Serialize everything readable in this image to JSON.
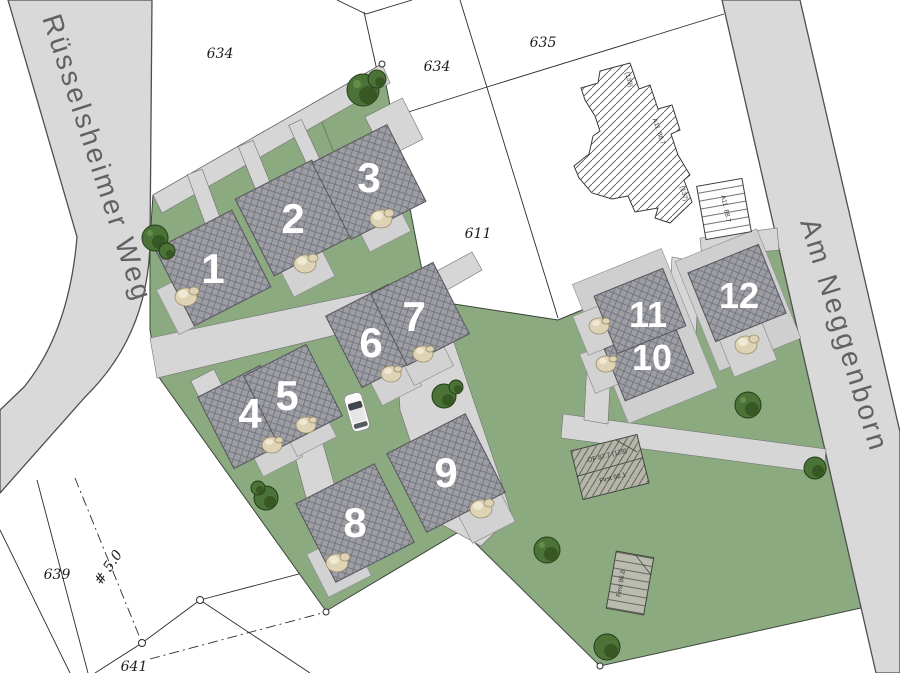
{
  "map": {
    "title": "Lageplan Baugebiet",
    "streets": [
      {
        "label": "Rüsselsheimer Weg"
      },
      {
        "label": "Am Neggenborn"
      }
    ],
    "parcels": [
      {
        "label": "634"
      },
      {
        "label": "634"
      },
      {
        "label": "635"
      },
      {
        "label": "611"
      },
      {
        "label": "639"
      },
      {
        "label": "641"
      }
    ],
    "plots": [
      {
        "number": "1"
      },
      {
        "number": "2"
      },
      {
        "number": "3"
      },
      {
        "number": "4"
      },
      {
        "number": "5"
      },
      {
        "number": "6"
      },
      {
        "number": "7"
      },
      {
        "number": "8"
      },
      {
        "number": "9"
      },
      {
        "number": "10"
      },
      {
        "number": "11"
      },
      {
        "number": "12"
      }
    ],
    "annotations": {
      "existing_building": {
        "label_top": "(139)",
        "label_mid": "A11. 88.7",
        "label_bottom": "(137)"
      },
      "garage": {
        "label": "A11. 88.7"
      },
      "planned_right": {
        "line1": "OF 87.7  (129)",
        "line2": "First 92.1"
      },
      "planned_bottom": {
        "label": "First 86.8"
      },
      "boundary_note": {
        "label": "# 5.0"
      }
    },
    "colors": {
      "site_green": "#8caa80",
      "road_gray": "#d9d9d9",
      "inner_road_gray": "#d6d6d6",
      "house_gray": "#9d9ea4",
      "driveway_gray": "#d2d2d2",
      "tree_green": "#4c7337",
      "shrub_beige": "#ded3b4",
      "boundary_line": "#2b2b2b",
      "street_text": "#616161"
    }
  }
}
